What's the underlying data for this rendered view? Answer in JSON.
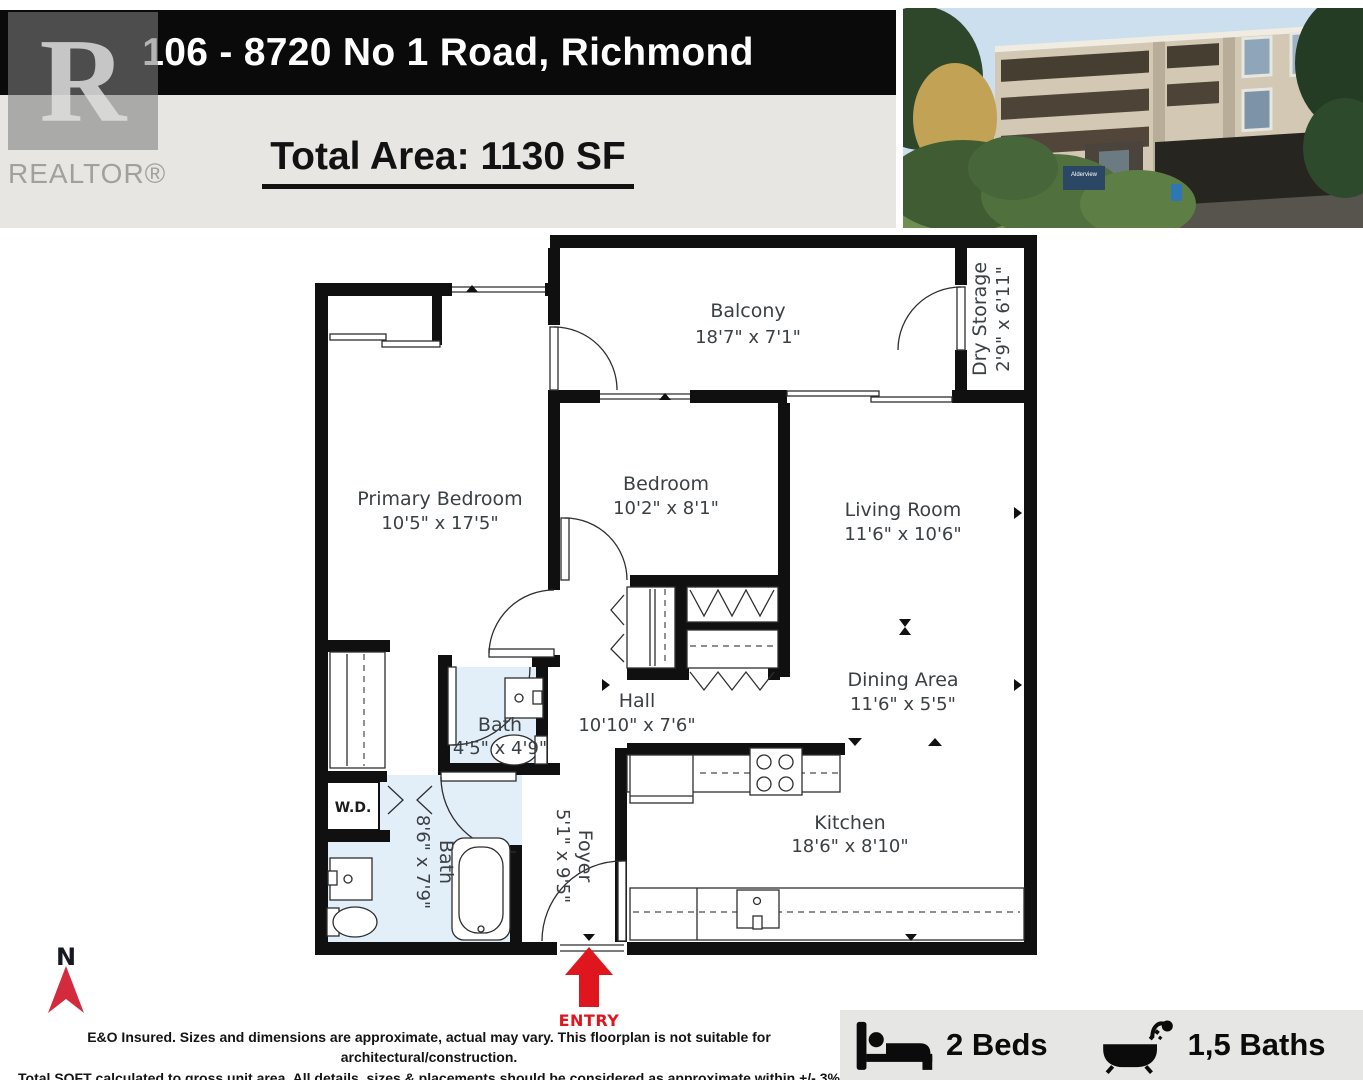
{
  "header": {
    "address": "106 - 8720 No 1 Road, Richmond",
    "total_area": "Total Area: 1130 SF"
  },
  "logo": {
    "letter": "R",
    "text": "REALTOR®"
  },
  "photo": {
    "sign_text": "Alderview"
  },
  "plan": {
    "north_label": "N",
    "entry_label": "ENTRY",
    "rooms": {
      "balcony": {
        "name": "Balcony",
        "dims": "18'7\" x 7'1\""
      },
      "dry_storage": {
        "name": "Dry Storage",
        "dims": "2'9\" x 6'11\""
      },
      "primary_bedroom": {
        "name": "Primary Bedroom",
        "dims": "10'5\" x 17'5\""
      },
      "bedroom": {
        "name": "Bedroom",
        "dims": "10'2\" x 8'1\""
      },
      "living_room": {
        "name": "Living Room",
        "dims": "11'6\" x 10'6\""
      },
      "dining_area": {
        "name": "Dining Area",
        "dims": "11'6\" x 5'5\""
      },
      "hall": {
        "name": "Hall",
        "dims": "10'10\" x 7'6\""
      },
      "bath_small": {
        "name": "Bath",
        "dims": "4'5\" x 4'9\""
      },
      "bath_large": {
        "name": "Bath",
        "dims": "8'6\" x 7'9\""
      },
      "wd": {
        "name": "W.D."
      },
      "foyer": {
        "name": "Foyer",
        "dims": "5'1\" x 9'5\""
      },
      "kitchen": {
        "name": "Kitchen",
        "dims": "18'6\" x 8'10\""
      }
    }
  },
  "footer": {
    "disclaimer_line1": "E&O Insured. Sizes and dimensions are approximate, actual may vary. This floorplan is not suitable for architectural/construction.",
    "disclaimer_line2": "Total SQFT calculated to gross unit area. All details, sizes & placements should be considered as approximate within +/- 3% tolerance.",
    "beds_label": "2 Beds",
    "baths_label": "1,5 Baths"
  },
  "colors": {
    "wall": "#101010",
    "bath_fill": "#e2eef8",
    "north_red": "#d42a3d",
    "entry_red": "#e0161f",
    "header_black": "#0a0a0a",
    "subheader_gray": "#e7e6e3",
    "stats_gray": "#e6e6e4"
  }
}
